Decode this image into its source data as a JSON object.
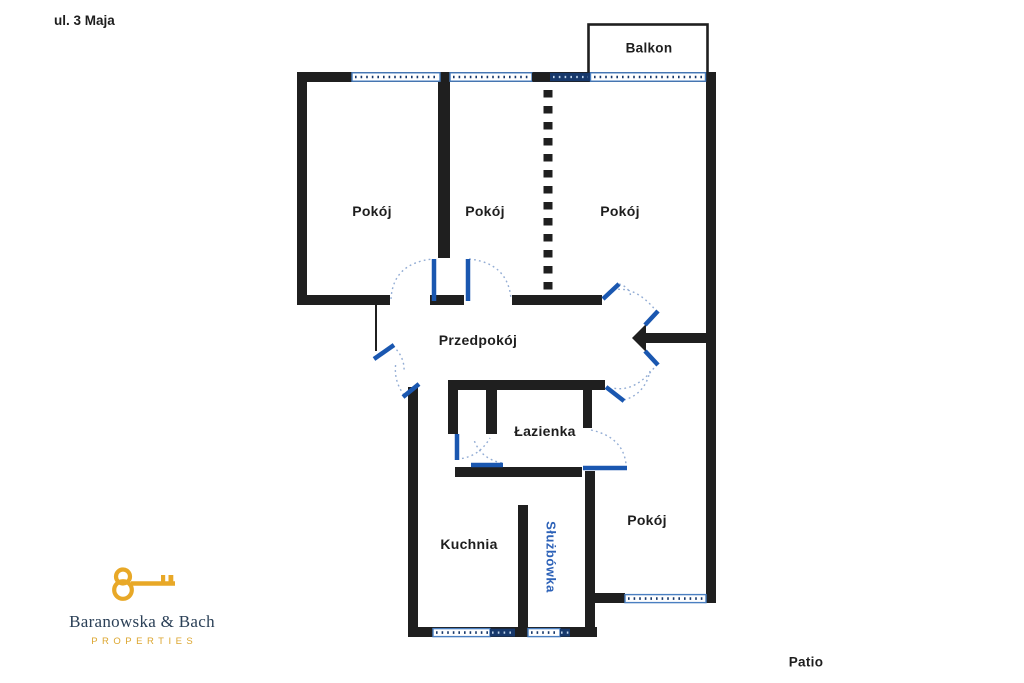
{
  "street_label": "ul. 3 Maja",
  "patio_label": "Patio",
  "balcony_label": "Balkon",
  "rooms": {
    "pokoj1": "Pokój",
    "pokoj2": "Pokój",
    "pokoj3": "Pokój",
    "przedpokoj": "Przedpokój",
    "lazienka": "Łazienka",
    "kuchnia": "Kuchnia",
    "sluzbowka": "Służbówka",
    "pokoj4": "Pokój"
  },
  "logo": {
    "name": "Baranowska & Bach",
    "subtitle": "PROPERTIES"
  },
  "colors": {
    "wall": "#1f1f1f",
    "door_leaf_blue": "#1a57b0",
    "door_arc_blue": "#92acd4",
    "window_frame_blue": "#4a7fc1",
    "window_navy": "#17386b",
    "label_text": "#1e1e1e",
    "sluzbowka_text": "#2d62b8",
    "logo_gold": "#e8a827",
    "logo_navy": "#2b4057"
  }
}
